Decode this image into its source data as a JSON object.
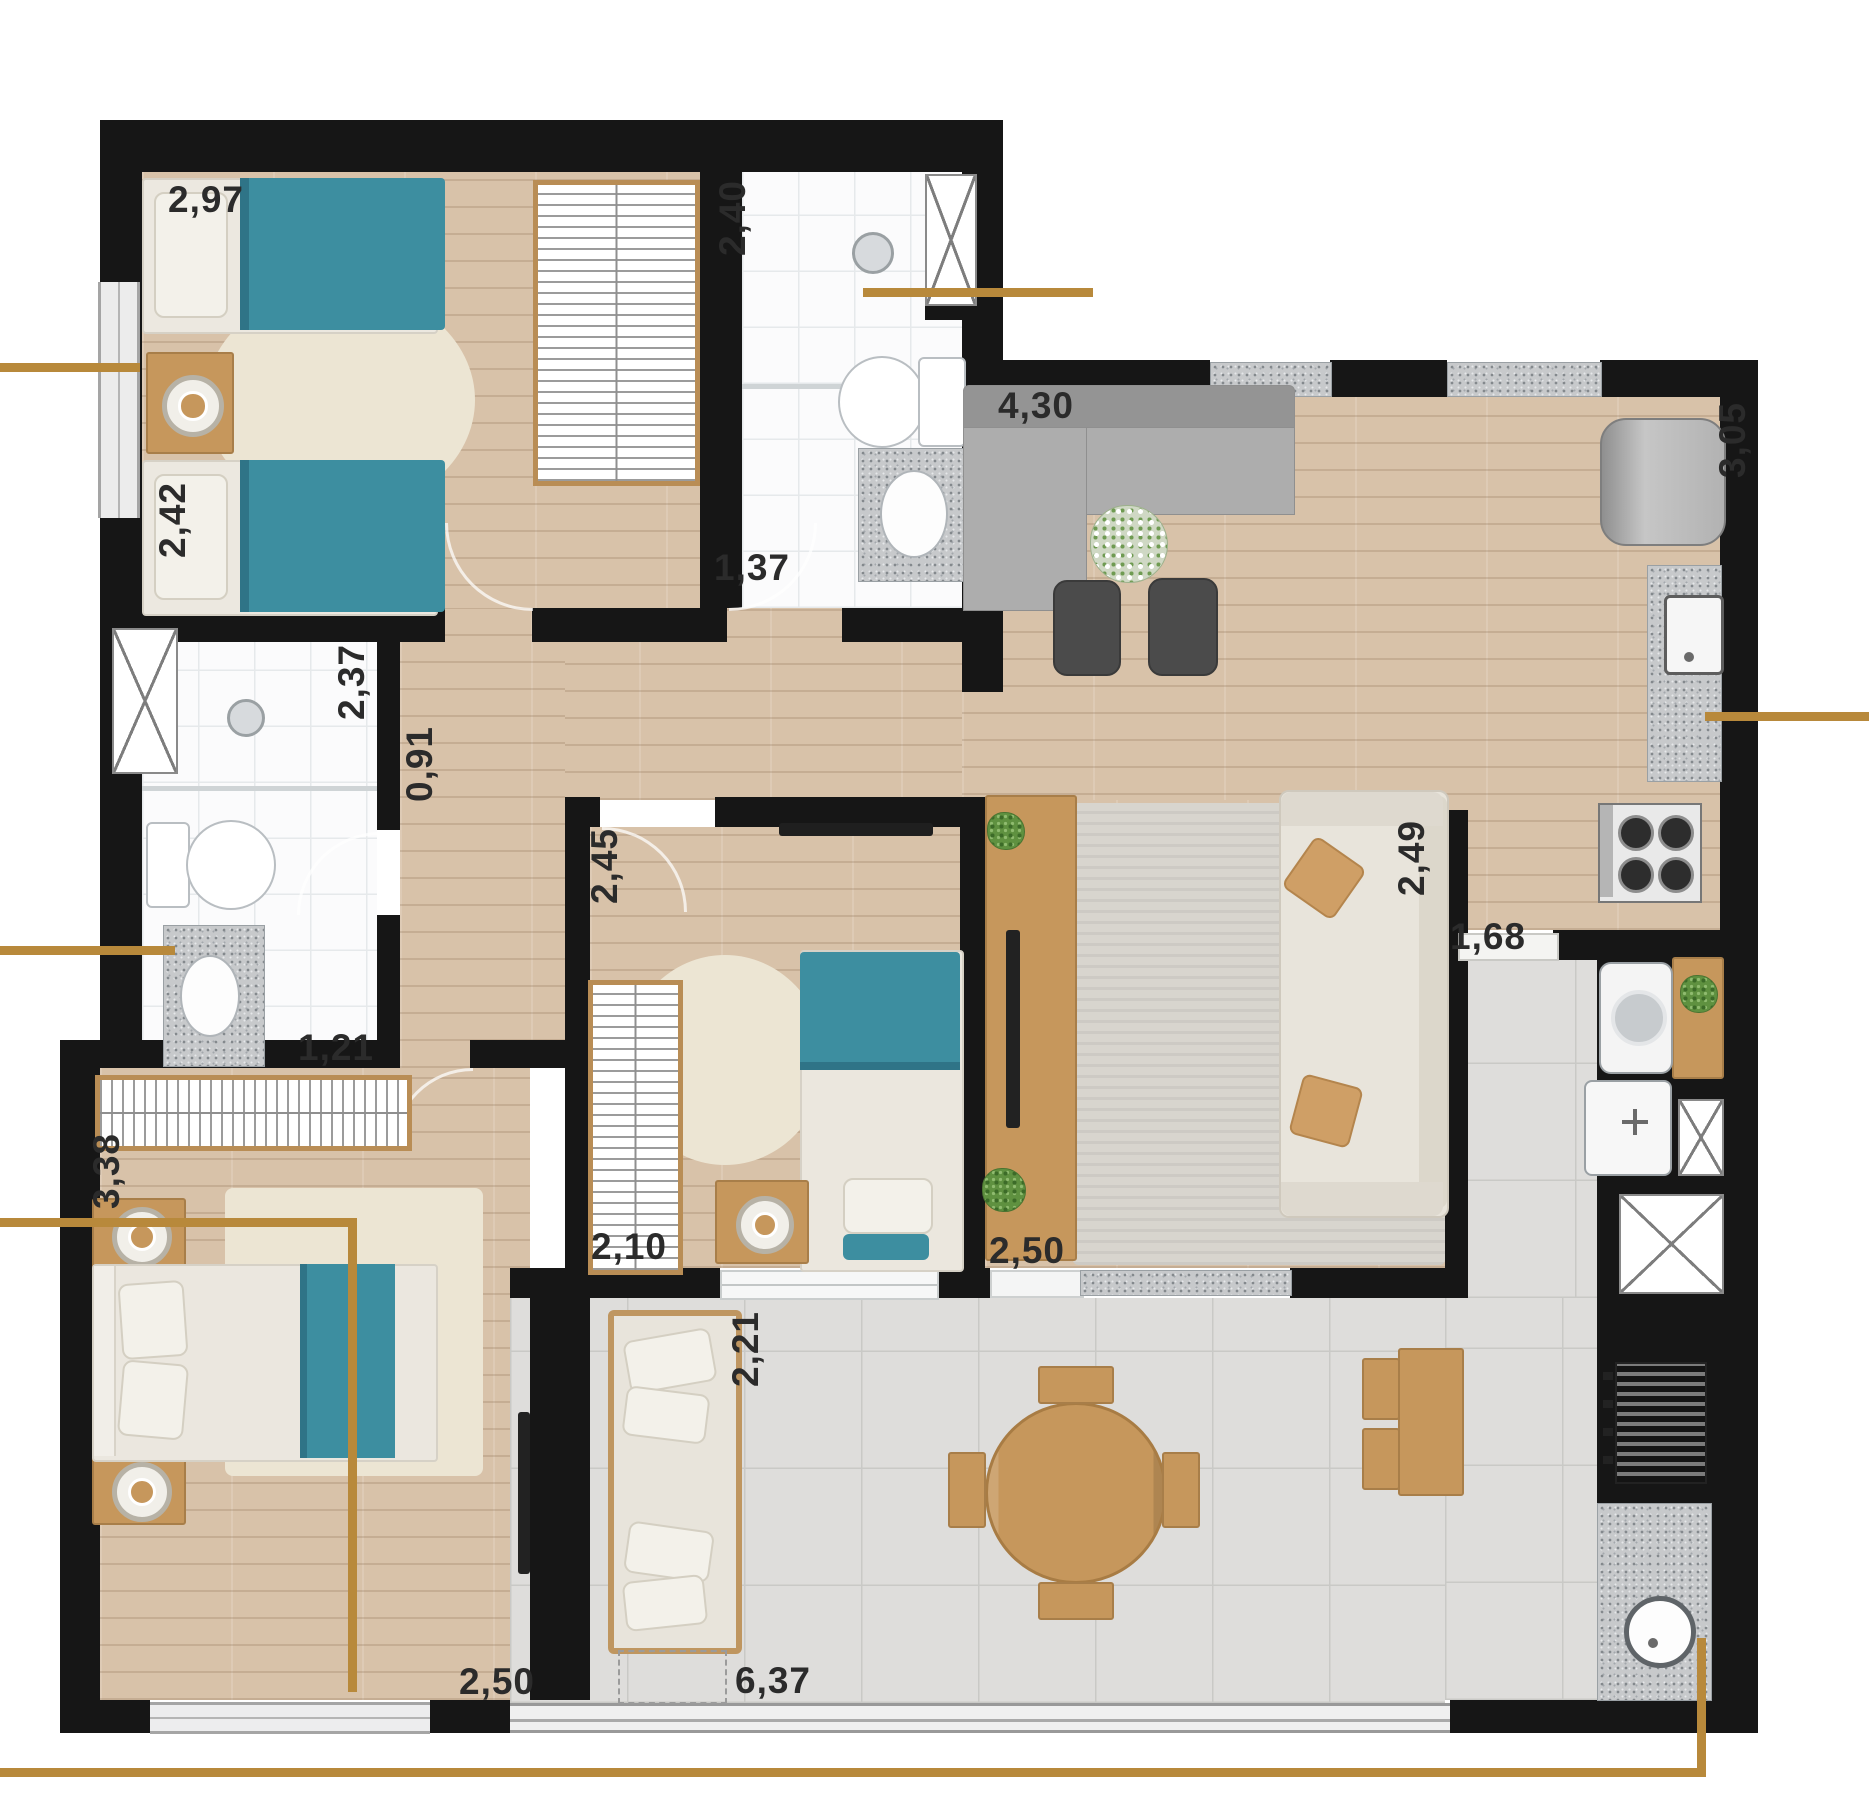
{
  "plan_type": "apartment-floor-plan-top-view",
  "colors": {
    "wall": "#161616",
    "gold": "#b8893b",
    "teal": "#3d8ea0",
    "teal-dark": "#2f7487",
    "wood": "#d8c2a9",
    "wood-furn": "#c6975c",
    "wood-trim": "#a87e49",
    "tile": "#dedddb",
    "bath": "#fbfbfc",
    "granite-base": "#c7c9cb",
    "rug-beige": "#ece5d3",
    "rug-gray": "#d8d5ce",
    "sofa-gray": "#adadad",
    "sofa-white": "#e8e4db",
    "green": "#5f9140",
    "text": "#2b2b2b"
  },
  "labels": [
    {
      "id": "bedroom1-width",
      "value": "2,97",
      "x": 206,
      "y": 200,
      "orient": "h"
    },
    {
      "id": "bedroom1-depth",
      "value": "2,42",
      "x": 173,
      "y": 520,
      "orient": "v"
    },
    {
      "id": "bath1-depth",
      "value": "2,40",
      "x": 733,
      "y": 218,
      "orient": "v"
    },
    {
      "id": "bath1-width",
      "value": "1,37",
      "x": 752,
      "y": 568,
      "orient": "h"
    },
    {
      "id": "living-width",
      "value": "4,30",
      "x": 1036,
      "y": 406,
      "orient": "h"
    },
    {
      "id": "kitchen-depth",
      "value": "3,05",
      "x": 1733,
      "y": 440,
      "orient": "v"
    },
    {
      "id": "bath2-depth",
      "value": "2,37",
      "x": 352,
      "y": 682,
      "orient": "v"
    },
    {
      "id": "hall-width",
      "value": "0,91",
      "x": 420,
      "y": 764,
      "orient": "v"
    },
    {
      "id": "midbed-depth",
      "value": "2,45",
      "x": 605,
      "y": 866,
      "orient": "v"
    },
    {
      "id": "suite-depth",
      "value": "2,49",
      "x": 1412,
      "y": 858,
      "orient": "v"
    },
    {
      "id": "service-width",
      "value": "1,68",
      "x": 1488,
      "y": 937,
      "orient": "h"
    },
    {
      "id": "bath2-width",
      "value": "1,21",
      "x": 336,
      "y": 1048,
      "orient": "h"
    },
    {
      "id": "master-depth",
      "value": "3,38",
      "x": 107,
      "y": 1171,
      "orient": "v"
    },
    {
      "id": "midbed-width",
      "value": "2,10",
      "x": 629,
      "y": 1247,
      "orient": "h"
    },
    {
      "id": "suite-width",
      "value": "2,50",
      "x": 1027,
      "y": 1251,
      "orient": "h"
    },
    {
      "id": "balcony-depth",
      "value": "2,21",
      "x": 746,
      "y": 1349,
      "orient": "v"
    },
    {
      "id": "master-width",
      "value": "2,50",
      "x": 497,
      "y": 1682,
      "orient": "h"
    },
    {
      "id": "balcony-width",
      "value": "6,37",
      "x": 773,
      "y": 1681,
      "orient": "h"
    }
  ],
  "icons": {
    "single-bed-icon": "css-rect-with-teal-blanket-and-pillow",
    "double-bed-icon": "css-rect-with-teal-throw-and-pillows",
    "nightstand-lamp-icon": "concentric-circles-on-wood-square",
    "wardrobe-icon": "white-box-with-hanger-hatch",
    "toilet-icon": "ellipse-bowl-with-tank",
    "sink-icon": "oval-basin-on-granite",
    "shower-head-icon": "small-gray-circle",
    "vent-shaft-icon": "white-box-with-x",
    "sofa-icon": "upholstered-rect-with-pillows",
    "round-dining-table-icon": "wood-circle-with-four-chairs",
    "fridge-icon": "gray-rounded-square",
    "cooktop-icon": "four-burner-circles",
    "washer-icon": "white-box-with-drum-circle",
    "laundry-tank-icon": "white-box-with-cross-faucet",
    "grill-icon": "dark-striped-box",
    "round-sink-icon": "circle-basin-on-granite",
    "plant-icon": "green-speckled-circle",
    "tv-icon": "thin-dark-bar",
    "rug-icon": "soft-rounded-rect-or-ellipse",
    "callout-line-icon": "gold-rule"
  }
}
